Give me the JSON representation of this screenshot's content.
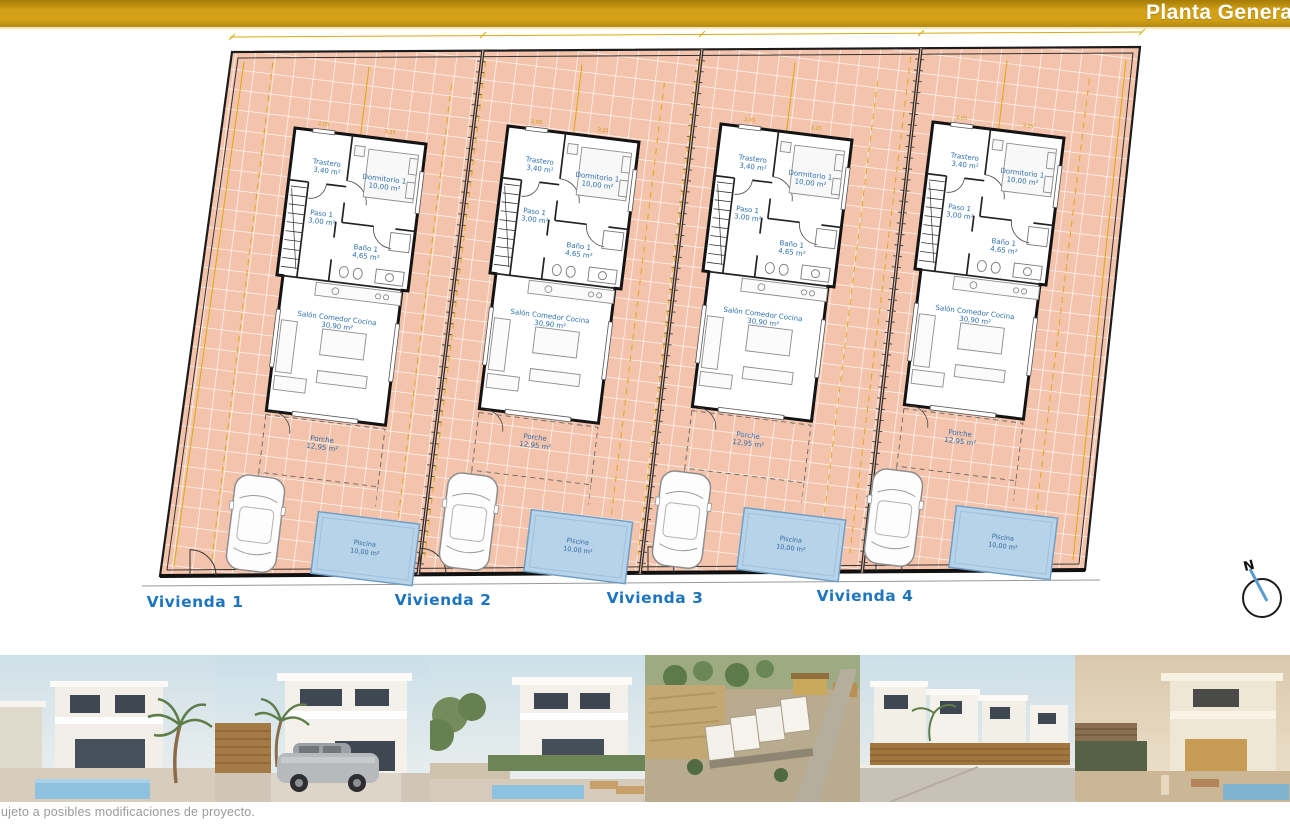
{
  "header": {
    "title": "Planta General"
  },
  "plan": {
    "viviendas": [
      "Vivienda 1",
      "Vivienda 2",
      "Vivienda 3",
      "Vivienda 4"
    ],
    "rooms": {
      "trastero": {
        "name": "Trastero",
        "area": "3,40 m²"
      },
      "dormitorio": {
        "name": "Dormitorio 1",
        "area": "10,00 m²"
      },
      "paso": {
        "name": "Paso 1",
        "area": "3,00 m²"
      },
      "bano": {
        "name": "Baño 1",
        "area": "4,65 m²"
      },
      "salon": {
        "name": "Salón Comedor Cocina",
        "area": "30,90 m²"
      },
      "porche": {
        "name": "Porche",
        "area": "12,95 m²"
      },
      "piscina": {
        "name": "Piscina",
        "area": "10,00 m²"
      }
    },
    "dims": {
      "dormitorio_width": "3,15",
      "trastero_width": "2,05"
    },
    "north_label": "N",
    "colors": {
      "header_gold": "#d2a117",
      "plot_salmon": "#f4c3ab",
      "pool_blue": "#b7d3e9",
      "room_label_blue": "#2e6fae",
      "vivienda_blue": "#1d74bf",
      "dimension_yellow": "#d9ab10"
    }
  },
  "footer": {
    "disclaimer": "ujeto a posibles modificaciones de proyecto."
  },
  "gallery": {
    "photos": [
      {
        "title": "Render fachada villa con piscina y palmera"
      },
      {
        "title": "Render villa con coche en la entrada"
      },
      {
        "title": "Render villa con solárium y jardín"
      },
      {
        "title": "Vista aérea de la promoción"
      },
      {
        "title": "Render calle con hilera de viviendas"
      },
      {
        "title": "Render villa al atardecer con piscina"
      }
    ]
  }
}
